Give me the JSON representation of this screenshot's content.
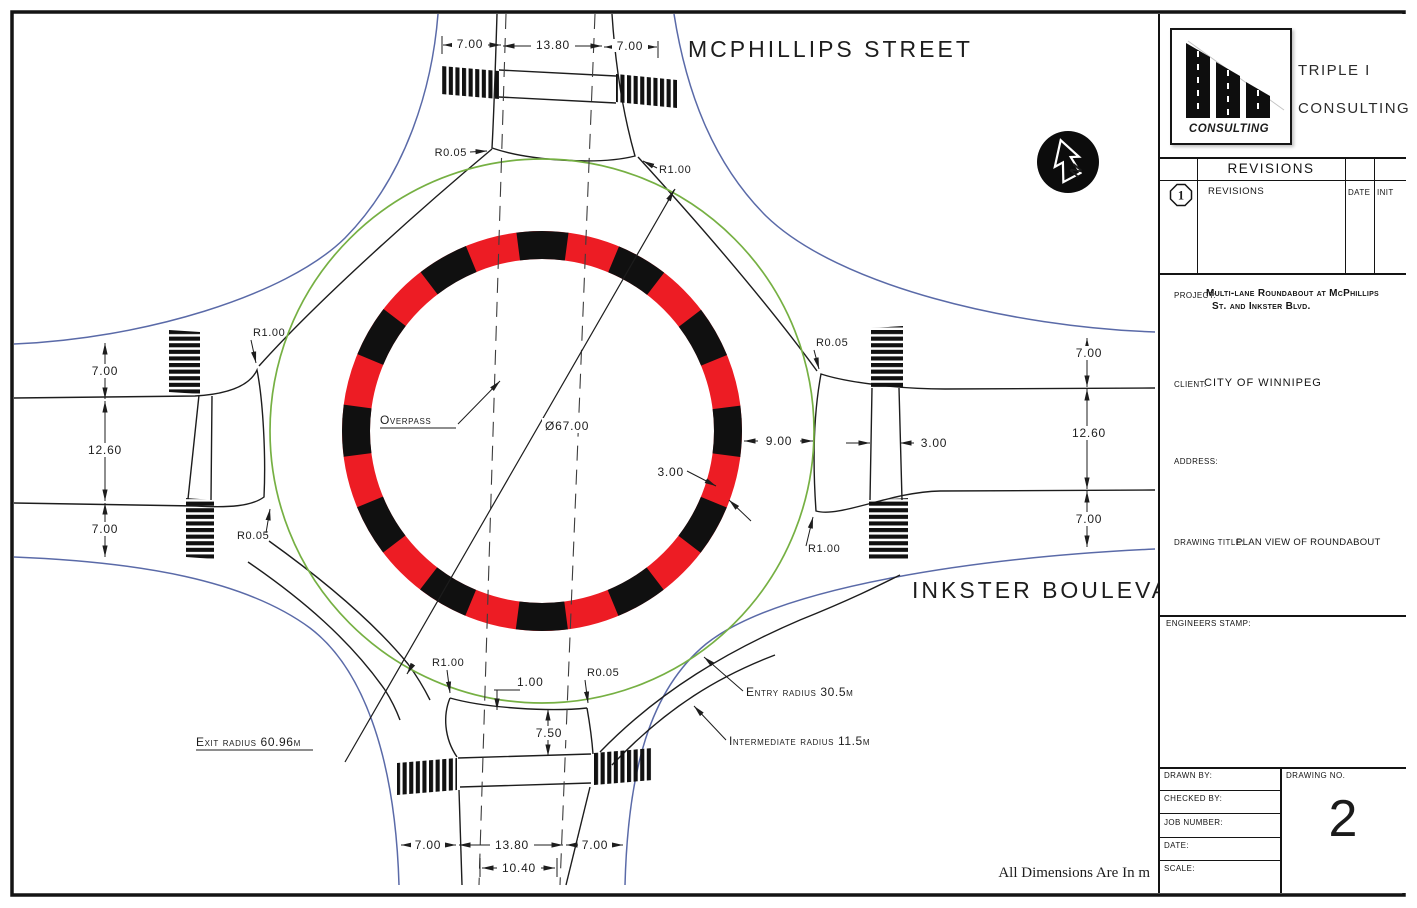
{
  "colors": {
    "ring_red": "#ed1c24",
    "apron_green": "#76b043",
    "road_edge_blue": "#5a6aa8",
    "line_black": "#1d1d1d"
  },
  "drawing": {
    "streets": {
      "top": "MCPHILLIPS STREET",
      "right": "INKSTER BOULEVARD"
    },
    "dims": {
      "north": [
        "7.00",
        "13.80",
        "7.00"
      ],
      "south": [
        "7.00",
        "13.80",
        "7.00"
      ],
      "south_inner": "10.40",
      "west": [
        "7.00",
        "12.60",
        "7.00"
      ],
      "east": [
        "7.00",
        "12.60",
        "7.00"
      ],
      "median_island_gap": "1.00",
      "median_island_length": "7.50",
      "circulating_width": "9.00",
      "crosswalk_width": "3.00",
      "ring_width": "3.00"
    },
    "radii": {
      "large": "R1.00",
      "small": "R0.05"
    },
    "callouts": {
      "overpass": "Overpass",
      "diameter": "Ø67.00",
      "entry": "Entry radius 30.5m",
      "intermediate": "Intermediate radius 11.5m",
      "exit": "Exit radius 60.96m"
    },
    "units_note": "All Dimensions Are In m"
  },
  "title_block": {
    "company": {
      "logo_caption": "CONSULTING",
      "name_line1": "TRIPLE I",
      "name_line2": "CONSULTING"
    },
    "revisions": {
      "header": "REVISIONS",
      "row_number": "1",
      "row_label": "REVISIONS",
      "col_date": "DATE",
      "col_init": "INIT"
    },
    "project": {
      "label": "PROJECT:",
      "line1": "Multi-lane Roundabout at McPhillips",
      "line2": "St. and Inkster Blvd."
    },
    "client": {
      "label": "CLIENT:",
      "value": "CITY OF WINNIPEG"
    },
    "address": {
      "label": "ADDRESS:"
    },
    "drawing_title": {
      "label": "DRAWING TITLE:",
      "value": "PLAN VIEW OF ROUNDABOUT"
    },
    "engineers_stamp_label": "ENGINEERS STAMP:",
    "fields": {
      "drawn_by": "DRAWN BY:",
      "checked_by": "CHECKED BY:",
      "job_number": "JOB NUMBER:",
      "date": "DATE:",
      "scale": "SCALE:"
    },
    "drawing_no": {
      "label": "DRAWING NO.",
      "value": "2"
    }
  }
}
